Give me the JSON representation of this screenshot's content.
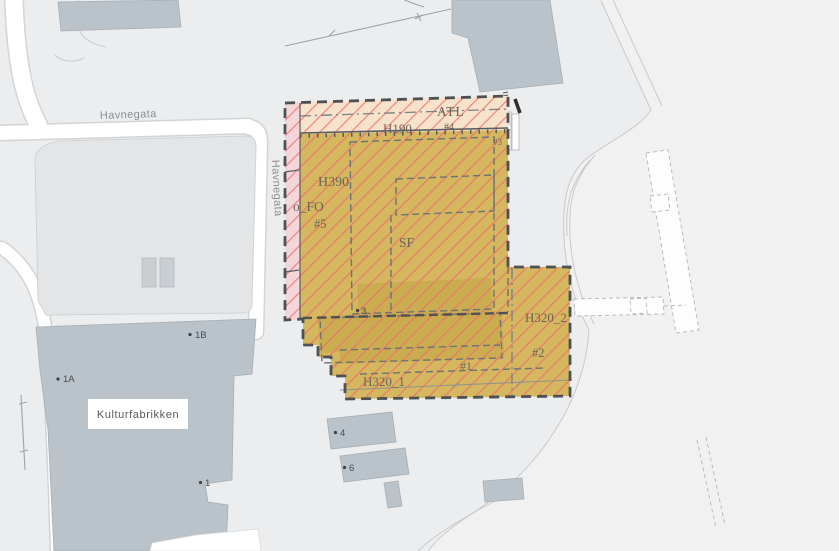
{
  "map": {
    "streets": {
      "havnegata_horizontal": "Havnegata",
      "havnegata_vertical": "Havnegata"
    },
    "places": {
      "kulturfabrikken": "Kulturfabrikken"
    },
    "zone_labels": {
      "atl": "ATL",
      "h190": "H190",
      "h390": "H390",
      "fo": "o_FO",
      "sf": "SF",
      "h320_1": "H320_1",
      "h320_2": "H320_2",
      "n1": "#1",
      "n2": "#2",
      "n3": "#3",
      "n4": "#4",
      "n5": "#5"
    },
    "point_labels": {
      "p1a": "1A",
      "p1b": "1B",
      "p1": "1",
      "p3": "3",
      "p4": "4",
      "p6": "6"
    },
    "colors": {
      "zone_tan": "#d4b75e",
      "zone_olive_dark": "#c8aa4d",
      "zone_peach": "#f7e2cb",
      "zone_pink": "#f5d6d8",
      "hazard_hatch_red": "#f2686a",
      "boundary_dark": "#4e5154",
      "building_gray": "#b9c3c9",
      "parking_gray": "#e3e5e6",
      "road_white": "#ffffff",
      "land_gray": "#ecedee",
      "shore_light": "#f1f1f2"
    }
  }
}
